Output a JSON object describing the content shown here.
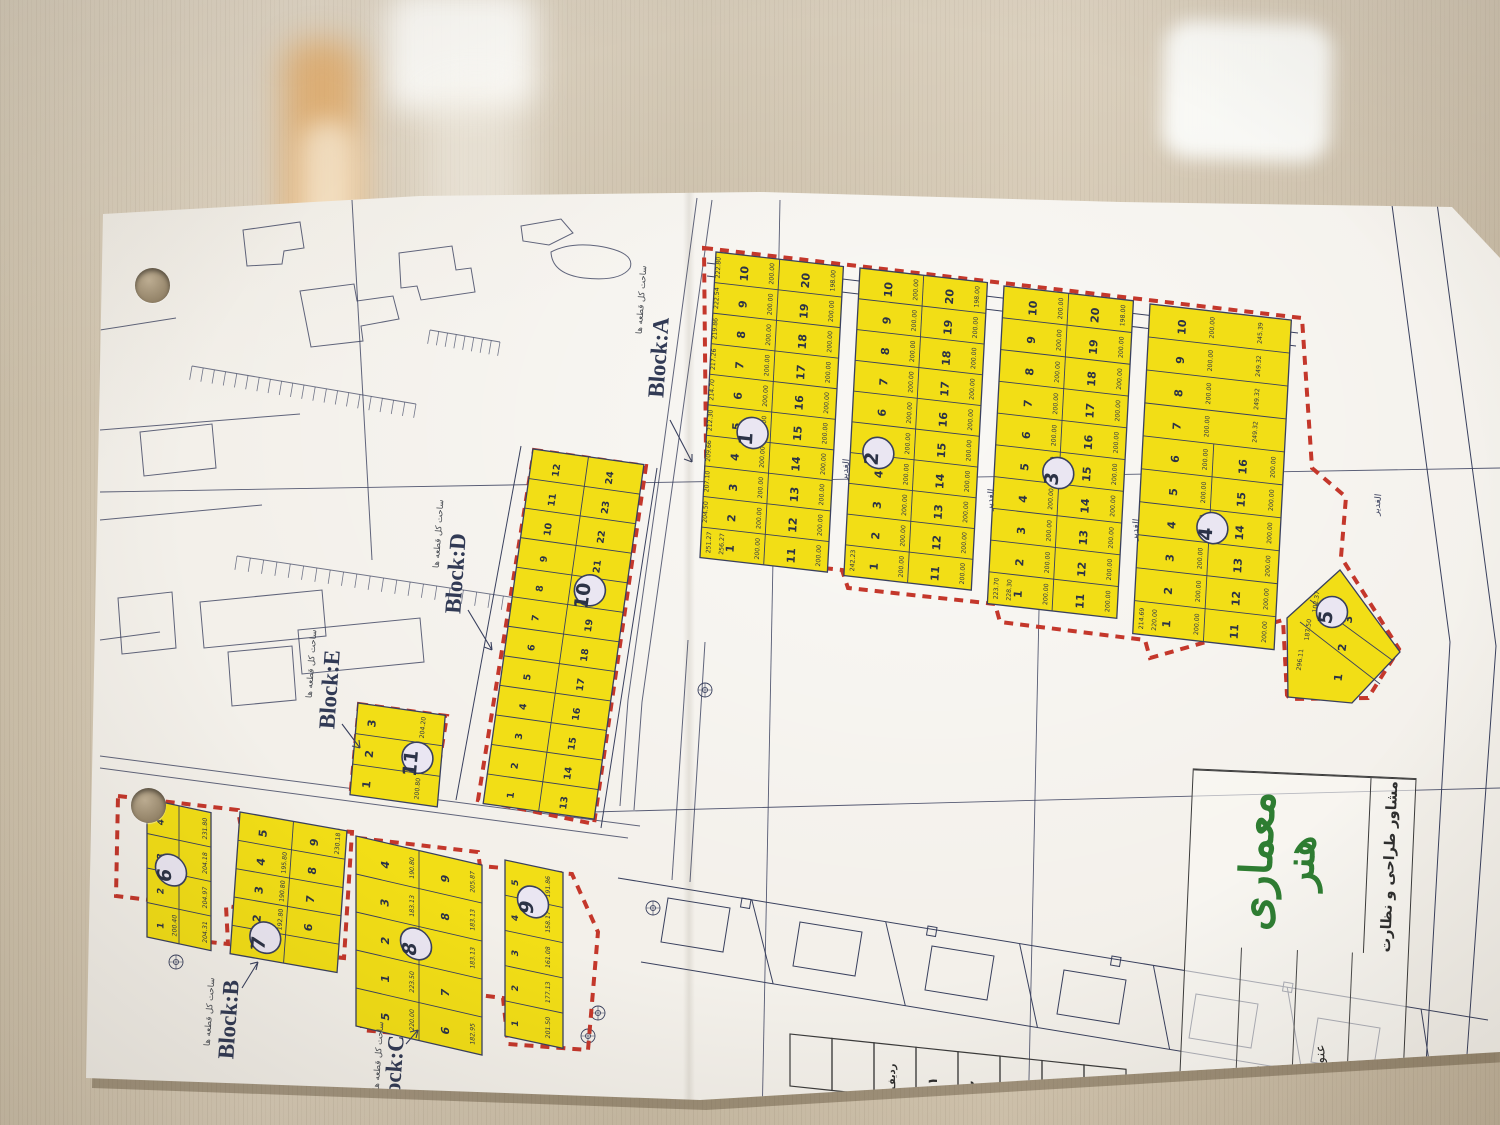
{
  "colors": {
    "parcel_fill": "#f2de16",
    "boundary_red": "#c4372b",
    "line_ink": "#39405e",
    "logo_green": "#2e7d32",
    "paper": "#f3f0ea",
    "wood": "#cfc3ad"
  },
  "map": {
    "street_label": "الغدیر",
    "area_annotation": "ساحت کل قطعه ها",
    "block_letter_labels": [
      "Block:A",
      "Block:B",
      "Block:C",
      "Block:D",
      "Block:E"
    ],
    "blocks": [
      {
        "name": "1",
        "circle": "1",
        "rows": 10,
        "cols": 2,
        "area_all": "200.00",
        "top_area": "198.00",
        "dims_left": [
          "222.80",
          "222.54",
          "219.86",
          "217.26",
          "214.70",
          "212.30",
          "209.66",
          "207.10",
          "204.50"
        ],
        "bottom_dims": [
          "251.27",
          "256.27"
        ]
      },
      {
        "name": "2",
        "circle": "2",
        "rows": 10,
        "cols": 2,
        "area_all": "200.00",
        "top_area": "198.00",
        "bottom_dims": [
          "242.23"
        ]
      },
      {
        "name": "3",
        "circle": "3",
        "rows": 10,
        "cols": 2,
        "area_all": "200.00",
        "top_area": "198.00",
        "bottom_dims": [
          "223.70",
          "228.30"
        ]
      },
      {
        "name": "4",
        "circle": "4",
        "rows": 10,
        "cols": 2,
        "merge_top_rows": 4,
        "labels_right": [
          "",
          "",
          "",
          "",
          "16",
          "15",
          "14",
          "13",
          "12",
          "11"
        ],
        "area_all": "200.00",
        "dims_right": [
          "245.39",
          "249.32",
          "249.32",
          "249.32"
        ],
        "bottom_dims": [
          "214.69",
          "220.00"
        ]
      },
      {
        "name": "5",
        "circle": "5",
        "parcels": [
          {
            "no": "1",
            "area": "296.11"
          },
          {
            "no": "2",
            "area": "187.50"
          },
          {
            "no": "3",
            "area": "102.37"
          }
        ]
      },
      {
        "name": "6",
        "circle": "6",
        "rows": 4,
        "cols": 2,
        "labels_left": [
          "4",
          "3",
          "2",
          "1"
        ],
        "labels_right": [
          "",
          "",
          "",
          ""
        ],
        "areas_right": [
          "231.80",
          "204.18",
          "204.97",
          "204.31"
        ],
        "areas_left": [
          "",
          "",
          "",
          "200.40"
        ]
      },
      {
        "name": "7",
        "circle": "7",
        "rows": 5,
        "cols": 2,
        "labels_left": [
          "5",
          "4",
          "3",
          "2",
          "1"
        ],
        "labels_right": [
          "9",
          "8",
          "7",
          "6",
          ""
        ],
        "areas_left": [
          "",
          "195.80",
          "190.80",
          "192.80",
          ""
        ],
        "areas_right": [
          "230.18",
          "",
          "",
          "",
          ""
        ]
      },
      {
        "name": "8",
        "circle": "8",
        "rows": 5,
        "cols": 2,
        "labels_left": [
          "4",
          "3",
          "2",
          "1",
          "5"
        ],
        "labels_right": [
          "9",
          "8",
          "",
          "7",
          "6"
        ],
        "areas_left": [
          "190.80",
          "183.13",
          "183.13",
          "223.50",
          "220.00"
        ],
        "areas_right": [
          "205.87",
          "183.13",
          "183.13",
          "",
          "182.95"
        ]
      },
      {
        "name": "9",
        "circle": "9",
        "rows": 5,
        "cols": 1,
        "labels_left": [
          "5",
          "4",
          "3",
          "2",
          "1"
        ],
        "areas_right": [
          "191.86",
          "158.17",
          "161.08",
          "177.13",
          "201.50"
        ]
      },
      {
        "name": "10",
        "circle": "10",
        "rows": 12,
        "cols": 2
      },
      {
        "name": "11",
        "circle": "11",
        "rows": 3,
        "cols": 1,
        "labels_left": [
          "3",
          "2",
          "1"
        ],
        "areas_right": [
          "204.20",
          "205.85",
          "200.80"
        ]
      }
    ]
  },
  "title_block": {
    "logo_line1": "معماری",
    "logo_line2": "هنر",
    "subtitle": "مشاور طراحی و نظارت",
    "rows": [
      {
        "label": "طراح:",
        "value": ""
      },
      {
        "label": "کــارفرما",
        "value": ""
      },
      {
        "label": "عنوان نقشــه",
        "value": ""
      },
      {
        "label": "تــاریخ:",
        "value": "۱۴۰۲/۶/۱۴"
      }
    ]
  },
  "row_table": {
    "title": "ردیف",
    "values": [
      "۱",
      "۲",
      "۳"
    ]
  }
}
